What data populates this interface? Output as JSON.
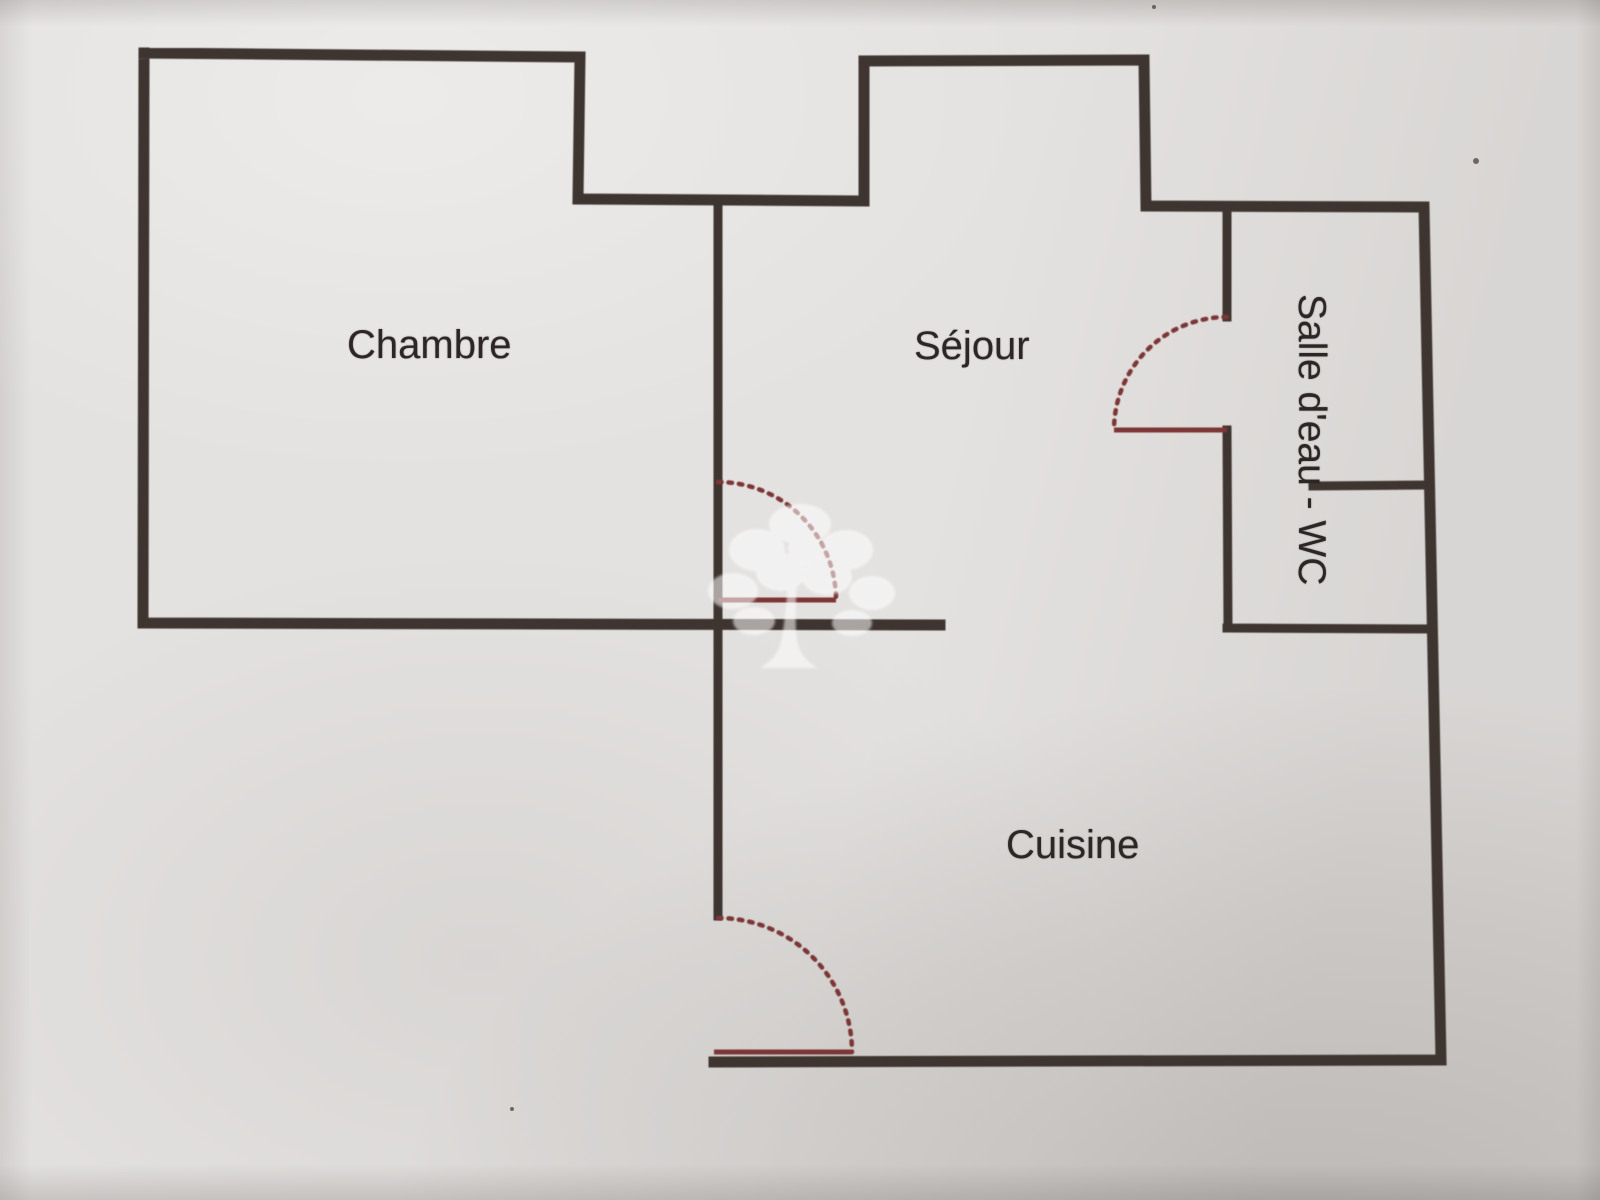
{
  "rooms": {
    "chambre": {
      "label": "Chambre"
    },
    "sejour": {
      "label": "Séjour"
    },
    "salle_eau_wc": {
      "label": "Salle d'eau - WC"
    },
    "cuisine": {
      "label": "Cuisine"
    }
  },
  "colors": {
    "paper": "#e4e2e0",
    "wall": "#3f3530",
    "door": "#7c3636",
    "label_text": "#2c2624",
    "watermark": "#ffffff"
  }
}
